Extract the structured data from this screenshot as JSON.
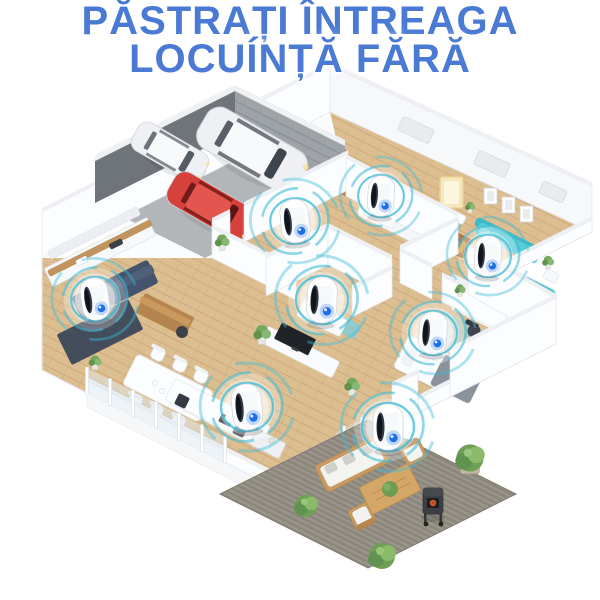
{
  "title": {
    "line1": "PĂSTRAȚI ÎNTREAGA",
    "line2": "LOCUÍNȚĂ FĂRĂ",
    "color": "#4a7ad3"
  },
  "palette": {
    "ring": "#3fbcd8",
    "ring_soft": "#9adeeb",
    "device_body": "#fcfdfe",
    "device_slot": "#333a45",
    "device_slot_dark": "#10151c",
    "led": "#1d6fe8",
    "led_ring": "#bcd4ff",
    "wood_floor": "#dcbe90",
    "wood_line": "#c9a47a",
    "wall_white": "#fcfdfe",
    "wall_shade": "#e2e5e9",
    "garage_floor": "#b2b6b9",
    "garage_wall_dark": "#6f747a",
    "garage_door": "#9ea3a8",
    "kitchen_island": "#44546d",
    "kitchen_rug": "#2e3e54",
    "counter_wood": "#c1945f",
    "teal_sofa": "#57cbd6",
    "aqua_rug": "#8fd5de",
    "patio_rug": "#918c82",
    "patio_wood": "#c89a63",
    "plant_green": "#74a85f",
    "car_white": "#eef0f3",
    "car_red": "#d6413c",
    "grill_body": "#3c4045",
    "grill_fire": "#e06a2d",
    "bed_gray": "#8a939c"
  },
  "devices": [
    {
      "name": "hallway",
      "x": 295,
      "y": 221,
      "scale": 0.95,
      "tilt": -6
    },
    {
      "name": "master-bedroom",
      "x": 381,
      "y": 196,
      "scale": 0.88,
      "tilt": 4
    },
    {
      "name": "guest-bedroom",
      "x": 488,
      "y": 256,
      "scale": 0.88,
      "tilt": 3
    },
    {
      "name": "kitchen",
      "x": 95,
      "y": 299,
      "scale": 0.92,
      "tilt": -8
    },
    {
      "name": "bathroom",
      "x": 322,
      "y": 300,
      "scale": 1.0,
      "tilt": 3
    },
    {
      "name": "office",
      "x": 433,
      "y": 333,
      "scale": 0.92,
      "tilt": 4
    },
    {
      "name": "living-room",
      "x": 247,
      "y": 407,
      "scale": 1.0,
      "tilt": -5
    },
    {
      "name": "patio",
      "x": 388,
      "y": 427,
      "scale": 1.0,
      "tilt": 0
    }
  ]
}
